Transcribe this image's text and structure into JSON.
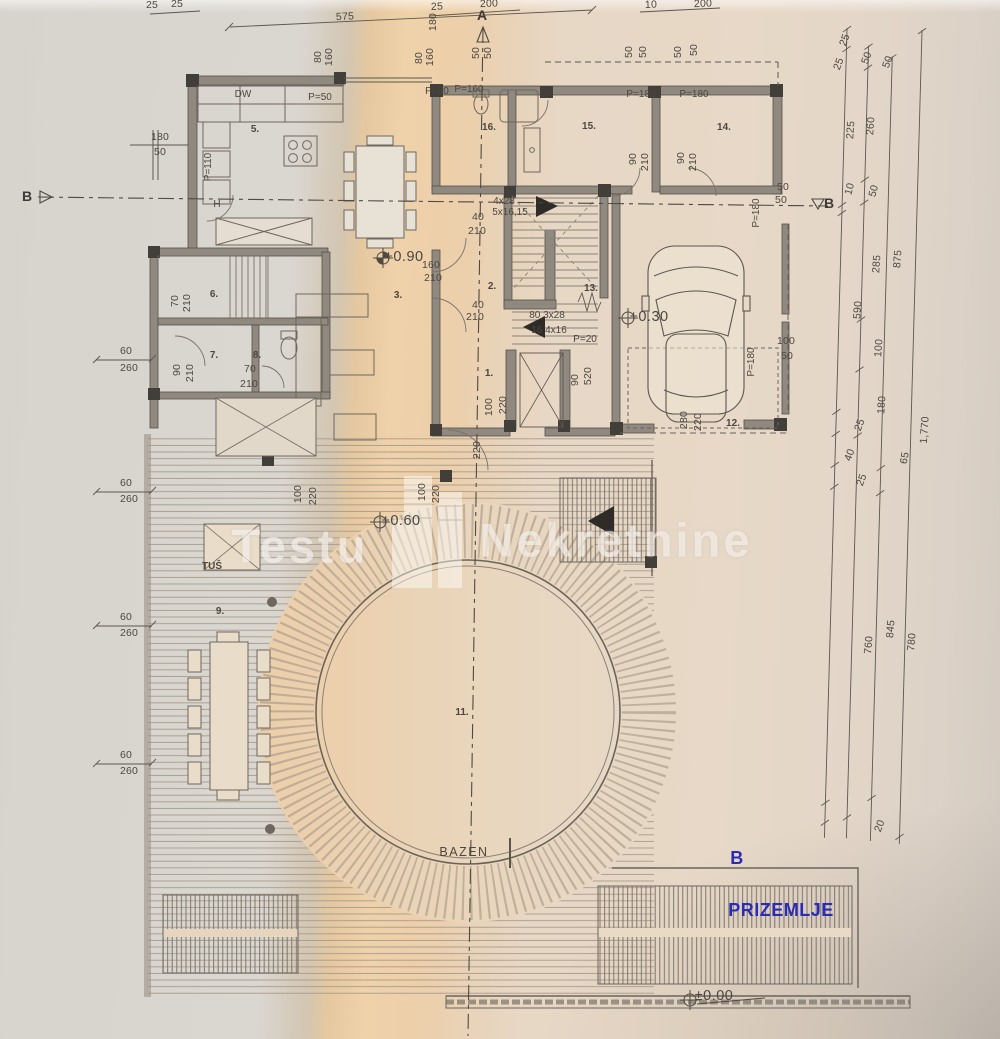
{
  "plan_title": {
    "floor_name": "PRIZEMLJE",
    "section_b_blue": "B"
  },
  "watermark": {
    "left_word": "Testu",
    "right_word": "Nekretnine"
  },
  "pool": {
    "label": "BAZEN"
  },
  "section_markers": {
    "a_top": "A",
    "b_left": "B",
    "b_right": "B"
  },
  "labels": {
    "levels": [
      {
        "t": "+0.90",
        "x": 404,
        "y": 257
      },
      {
        "t": "+0.30",
        "x": 649,
        "y": 317
      },
      {
        "t": "+0.60",
        "x": 401,
        "y": 521
      },
      {
        "t": "±0.00",
        "x": 714,
        "y": 996
      }
    ],
    "rooms": [
      {
        "t": "5.",
        "x": 255,
        "y": 130
      },
      {
        "t": "16.",
        "x": 489,
        "y": 128
      },
      {
        "t": "15.",
        "x": 589,
        "y": 127
      },
      {
        "t": "14.",
        "x": 724,
        "y": 128
      },
      {
        "t": "6.",
        "x": 214,
        "y": 295
      },
      {
        "t": "7.",
        "x": 214,
        "y": 356
      },
      {
        "t": "8.",
        "x": 257,
        "y": 356
      },
      {
        "t": "3.",
        "x": 398,
        "y": 296
      },
      {
        "t": "2.",
        "x": 492,
        "y": 287
      },
      {
        "t": "13.",
        "x": 591,
        "y": 289
      },
      {
        "t": "1.",
        "x": 489,
        "y": 374
      },
      {
        "t": "12.",
        "x": 733,
        "y": 424
      },
      {
        "t": "9.",
        "x": 220,
        "y": 612
      },
      {
        "t": "11.",
        "x": 462,
        "y": 713
      },
      {
        "t": "TUŠ",
        "x": 212,
        "y": 567
      }
    ],
    "stairs": [
      {
        "t": "4x28",
        "x": 504,
        "y": 202
      },
      {
        "t": "5x16,15",
        "x": 510,
        "y": 213
      },
      {
        "t": "80 3x28",
        "x": 547,
        "y": 316
      },
      {
        "t": "16 4x16",
        "x": 549,
        "y": 331
      }
    ],
    "openings": [
      {
        "t": "DW",
        "x": 243,
        "y": 95
      },
      {
        "t": "P=50",
        "x": 320,
        "y": 98
      },
      {
        "t": "P=50",
        "x": 437,
        "y": 92
      },
      {
        "t": "P=160",
        "x": 469,
        "y": 90
      },
      {
        "t": "P=180",
        "x": 641,
        "y": 95
      },
      {
        "t": "P=180",
        "x": 694,
        "y": 95
      },
      {
        "t": "P=110",
        "x": 209,
        "y": 167,
        "r": -90
      },
      {
        "t": "P=180",
        "x": 757,
        "y": 213,
        "r": -90
      },
      {
        "t": "P=180",
        "x": 752,
        "y": 362,
        "r": -90
      },
      {
        "t": "P=20",
        "x": 585,
        "y": 340
      },
      {
        "t": "H",
        "x": 217,
        "y": 205
      }
    ],
    "dims": [
      {
        "t": "25",
        "x": 152,
        "y": 5
      },
      {
        "t": "25",
        "x": 177,
        "y": 4
      },
      {
        "t": "575",
        "x": 345,
        "y": 17,
        "r": -2
      },
      {
        "t": "25",
        "x": 437,
        "y": 7,
        "r": -2
      },
      {
        "t": "200",
        "x": 489,
        "y": 4,
        "r": -2
      },
      {
        "t": "10",
        "x": 651,
        "y": 5,
        "r": -2
      },
      {
        "t": "200",
        "x": 703,
        "y": 4,
        "r": -2
      },
      {
        "t": "80",
        "x": 318,
        "y": 57,
        "r": -90
      },
      {
        "t": "160",
        "x": 329,
        "y": 57,
        "r": -90
      },
      {
        "t": "80",
        "x": 419,
        "y": 58,
        "r": -90
      },
      {
        "t": "160",
        "x": 430,
        "y": 57,
        "r": -90
      },
      {
        "t": "180",
        "x": 433,
        "y": 22,
        "r": -90
      },
      {
        "t": "50",
        "x": 476,
        "y": 53,
        "r": -90
      },
      {
        "t": "50",
        "x": 488,
        "y": 53,
        "r": -90
      },
      {
        "t": "50",
        "x": 629,
        "y": 52,
        "r": -90
      },
      {
        "t": "50",
        "x": 643,
        "y": 52,
        "r": -90
      },
      {
        "t": "50",
        "x": 678,
        "y": 52,
        "r": -90
      },
      {
        "t": "50",
        "x": 694,
        "y": 50,
        "r": -90
      },
      {
        "t": "180",
        "x": 160,
        "y": 137
      },
      {
        "t": "50",
        "x": 160,
        "y": 152
      },
      {
        "t": "60",
        "x": 126,
        "y": 351
      },
      {
        "t": "260",
        "x": 129,
        "y": 368
      },
      {
        "t": "60",
        "x": 126,
        "y": 483
      },
      {
        "t": "260",
        "x": 129,
        "y": 499
      },
      {
        "t": "60",
        "x": 126,
        "y": 617
      },
      {
        "t": "260",
        "x": 129,
        "y": 633
      },
      {
        "t": "60",
        "x": 126,
        "y": 755
      },
      {
        "t": "260",
        "x": 129,
        "y": 771
      },
      {
        "t": "90",
        "x": 633,
        "y": 159,
        "r": -90
      },
      {
        "t": "210",
        "x": 645,
        "y": 162,
        "r": -90
      },
      {
        "t": "90",
        "x": 681,
        "y": 158,
        "r": -90
      },
      {
        "t": "210",
        "x": 693,
        "y": 162,
        "r": -90
      },
      {
        "t": "50",
        "x": 783,
        "y": 187
      },
      {
        "t": "50",
        "x": 781,
        "y": 200
      },
      {
        "t": "100",
        "x": 786,
        "y": 341
      },
      {
        "t": "50",
        "x": 787,
        "y": 356
      },
      {
        "t": "280",
        "x": 684,
        "y": 420,
        "r": -90
      },
      {
        "t": "220",
        "x": 698,
        "y": 422,
        "r": -90
      },
      {
        "t": "40",
        "x": 478,
        "y": 217
      },
      {
        "t": "210",
        "x": 477,
        "y": 231
      },
      {
        "t": "160",
        "x": 431,
        "y": 265
      },
      {
        "t": "210",
        "x": 433,
        "y": 278
      },
      {
        "t": "40",
        "x": 478,
        "y": 305
      },
      {
        "t": "210",
        "x": 475,
        "y": 317
      },
      {
        "t": "70",
        "x": 175,
        "y": 301,
        "r": -90
      },
      {
        "t": "210",
        "x": 187,
        "y": 303,
        "r": -90
      },
      {
        "t": "90",
        "x": 177,
        "y": 370,
        "r": -90
      },
      {
        "t": "210",
        "x": 190,
        "y": 373,
        "r": -90
      },
      {
        "t": "70",
        "x": 250,
        "y": 369
      },
      {
        "t": "210",
        "x": 249,
        "y": 384
      },
      {
        "t": "90",
        "x": 575,
        "y": 380,
        "r": -90
      },
      {
        "t": "520",
        "x": 588,
        "y": 376,
        "r": -90
      },
      {
        "t": "100",
        "x": 489,
        "y": 407,
        "r": -90
      },
      {
        "t": "220",
        "x": 503,
        "y": 405,
        "r": -90
      },
      {
        "t": "220",
        "x": 477,
        "y": 450,
        "r": -90
      },
      {
        "t": "100",
        "x": 298,
        "y": 494,
        "r": -90
      },
      {
        "t": "220",
        "x": 313,
        "y": 496,
        "r": -90
      },
      {
        "t": "100",
        "x": 422,
        "y": 492,
        "r": -90
      },
      {
        "t": "220",
        "x": 436,
        "y": 494,
        "r": -90
      },
      {
        "t": "25",
        "x": 845,
        "y": 40,
        "r": -70
      },
      {
        "t": "25",
        "x": 839,
        "y": 64,
        "r": -70
      },
      {
        "t": "50",
        "x": 867,
        "y": 58,
        "r": -70
      },
      {
        "t": "50",
        "x": 888,
        "y": 62,
        "r": -70
      },
      {
        "t": "225",
        "x": 851,
        "y": 130,
        "r": -86
      },
      {
        "t": "260",
        "x": 871,
        "y": 126,
        "r": -86
      },
      {
        "t": "10",
        "x": 850,
        "y": 189,
        "r": -75
      },
      {
        "t": "50",
        "x": 874,
        "y": 191,
        "r": -75
      },
      {
        "t": "285",
        "x": 877,
        "y": 264,
        "r": -86
      },
      {
        "t": "875",
        "x": 898,
        "y": 259,
        "r": -86
      },
      {
        "t": "590",
        "x": 858,
        "y": 310,
        "r": -86
      },
      {
        "t": "100",
        "x": 879,
        "y": 348,
        "r": -86
      },
      {
        "t": "180",
        "x": 882,
        "y": 405,
        "r": -86
      },
      {
        "t": "25",
        "x": 860,
        "y": 425,
        "r": -70
      },
      {
        "t": "40",
        "x": 850,
        "y": 455,
        "r": -70
      },
      {
        "t": "25",
        "x": 862,
        "y": 480,
        "r": -70
      },
      {
        "t": "65",
        "x": 905,
        "y": 458,
        "r": -80
      },
      {
        "t": "1,770",
        "x": 925,
        "y": 430,
        "r": -86
      },
      {
        "t": "760",
        "x": 869,
        "y": 645,
        "r": -85
      },
      {
        "t": "845",
        "x": 891,
        "y": 629,
        "r": -85
      },
      {
        "t": "780",
        "x": 912,
        "y": 642,
        "r": -85
      },
      {
        "t": "20",
        "x": 880,
        "y": 826,
        "r": -70
      }
    ]
  }
}
